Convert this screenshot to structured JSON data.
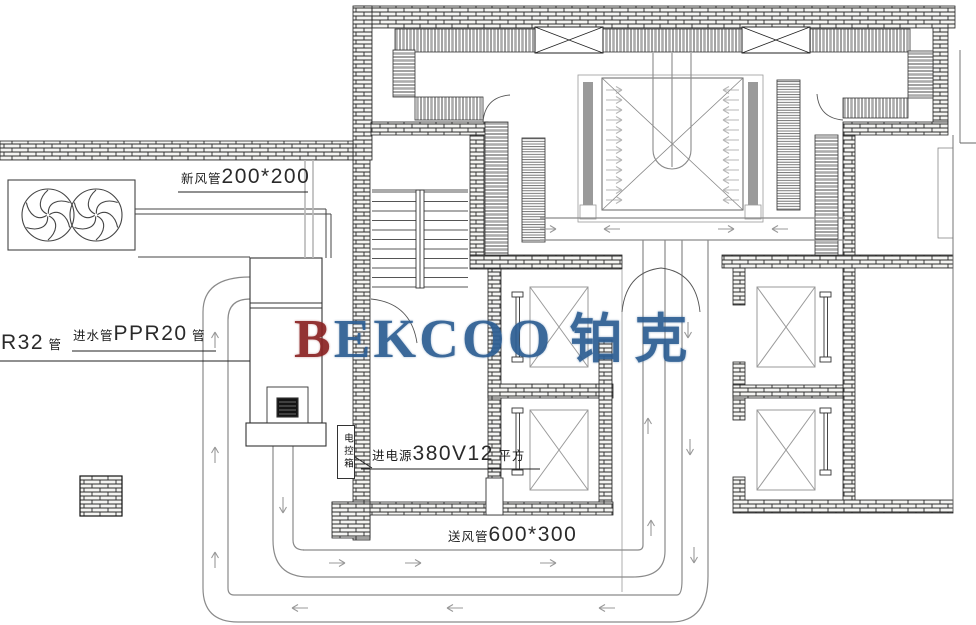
{
  "drawing": {
    "type": "HVAC floor plan",
    "watermark": {
      "letter_b": "B",
      "letters_rest": "EKCOO",
      "chinese": "铂克",
      "color_b": "#8b2424",
      "color_main": "#2d5e93"
    },
    "labels": {
      "fresh_air_duct": {
        "prefix": "新风管",
        "dim": "200*200"
      },
      "r32_pipe": {
        "dim": "R32",
        "suffix": "管"
      },
      "water_inlet_pipe": {
        "prefix": "进水管",
        "dim": "PPR20",
        "suffix": "管"
      },
      "power_supply": {
        "prefix": "进电源",
        "dim": "380V12",
        "suffix": "平方"
      },
      "supply_air_duct": {
        "prefix": "送风管",
        "dim": "600*300"
      },
      "electric_control_box": {
        "text": "电控箱"
      }
    },
    "colors": {
      "wall_line": "#222222",
      "duct_line": "#888888",
      "arrow": "#999999",
      "equipment_gray": "#9a9a9a"
    }
  }
}
